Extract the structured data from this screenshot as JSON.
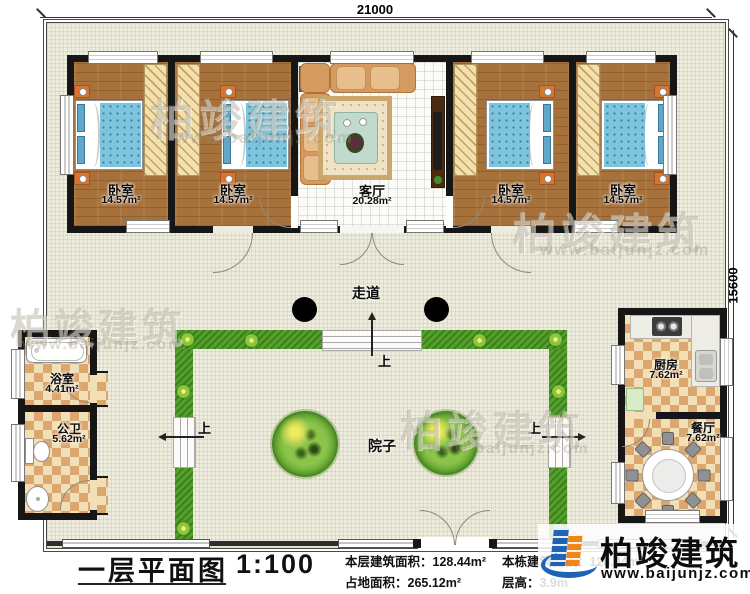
{
  "dimensions": {
    "top": "21000",
    "right": "15600"
  },
  "rooms": {
    "bedroom1": {
      "name": "卧室",
      "area": "14.57m²"
    },
    "bedroom2": {
      "name": "卧室",
      "area": "14.57m²"
    },
    "bedroom3": {
      "name": "卧室",
      "area": "14.57m²"
    },
    "bedroom4": {
      "name": "卧室",
      "area": "14.57m²"
    },
    "living": {
      "name": "客厅",
      "area": "20.28m²"
    },
    "corridor": {
      "name": "走道"
    },
    "courtyard": {
      "name": "院子"
    },
    "bath": {
      "name": "浴室",
      "area": "4.41m²"
    },
    "toilet": {
      "name": "公卫",
      "area": "5.62m²"
    },
    "kitchen": {
      "name": "厨房",
      "area": "7.62m²"
    },
    "dining": {
      "name": "餐厅",
      "area": "7.62m²"
    }
  },
  "steps": {
    "up_label": "上"
  },
  "titleblock": {
    "title": "一层平面图",
    "scale": "1:100",
    "stats": [
      "本层建筑面积：128.44m²",
      "占地面积：265.12m²",
      "本栋建筑面积：128.44m²",
      "层高：3.9m"
    ]
  },
  "logo": {
    "company": "柏竣建筑",
    "website": "www.baijunjz.com"
  },
  "watermark": {
    "text": "柏竣建筑",
    "url": "www.baijunjz.com"
  },
  "colors": {
    "hedge": "#55A02C",
    "wall": "#161616",
    "wood": "#A6713A",
    "logo_blue": "#1E63B5",
    "logo_orange": "#F08519"
  }
}
